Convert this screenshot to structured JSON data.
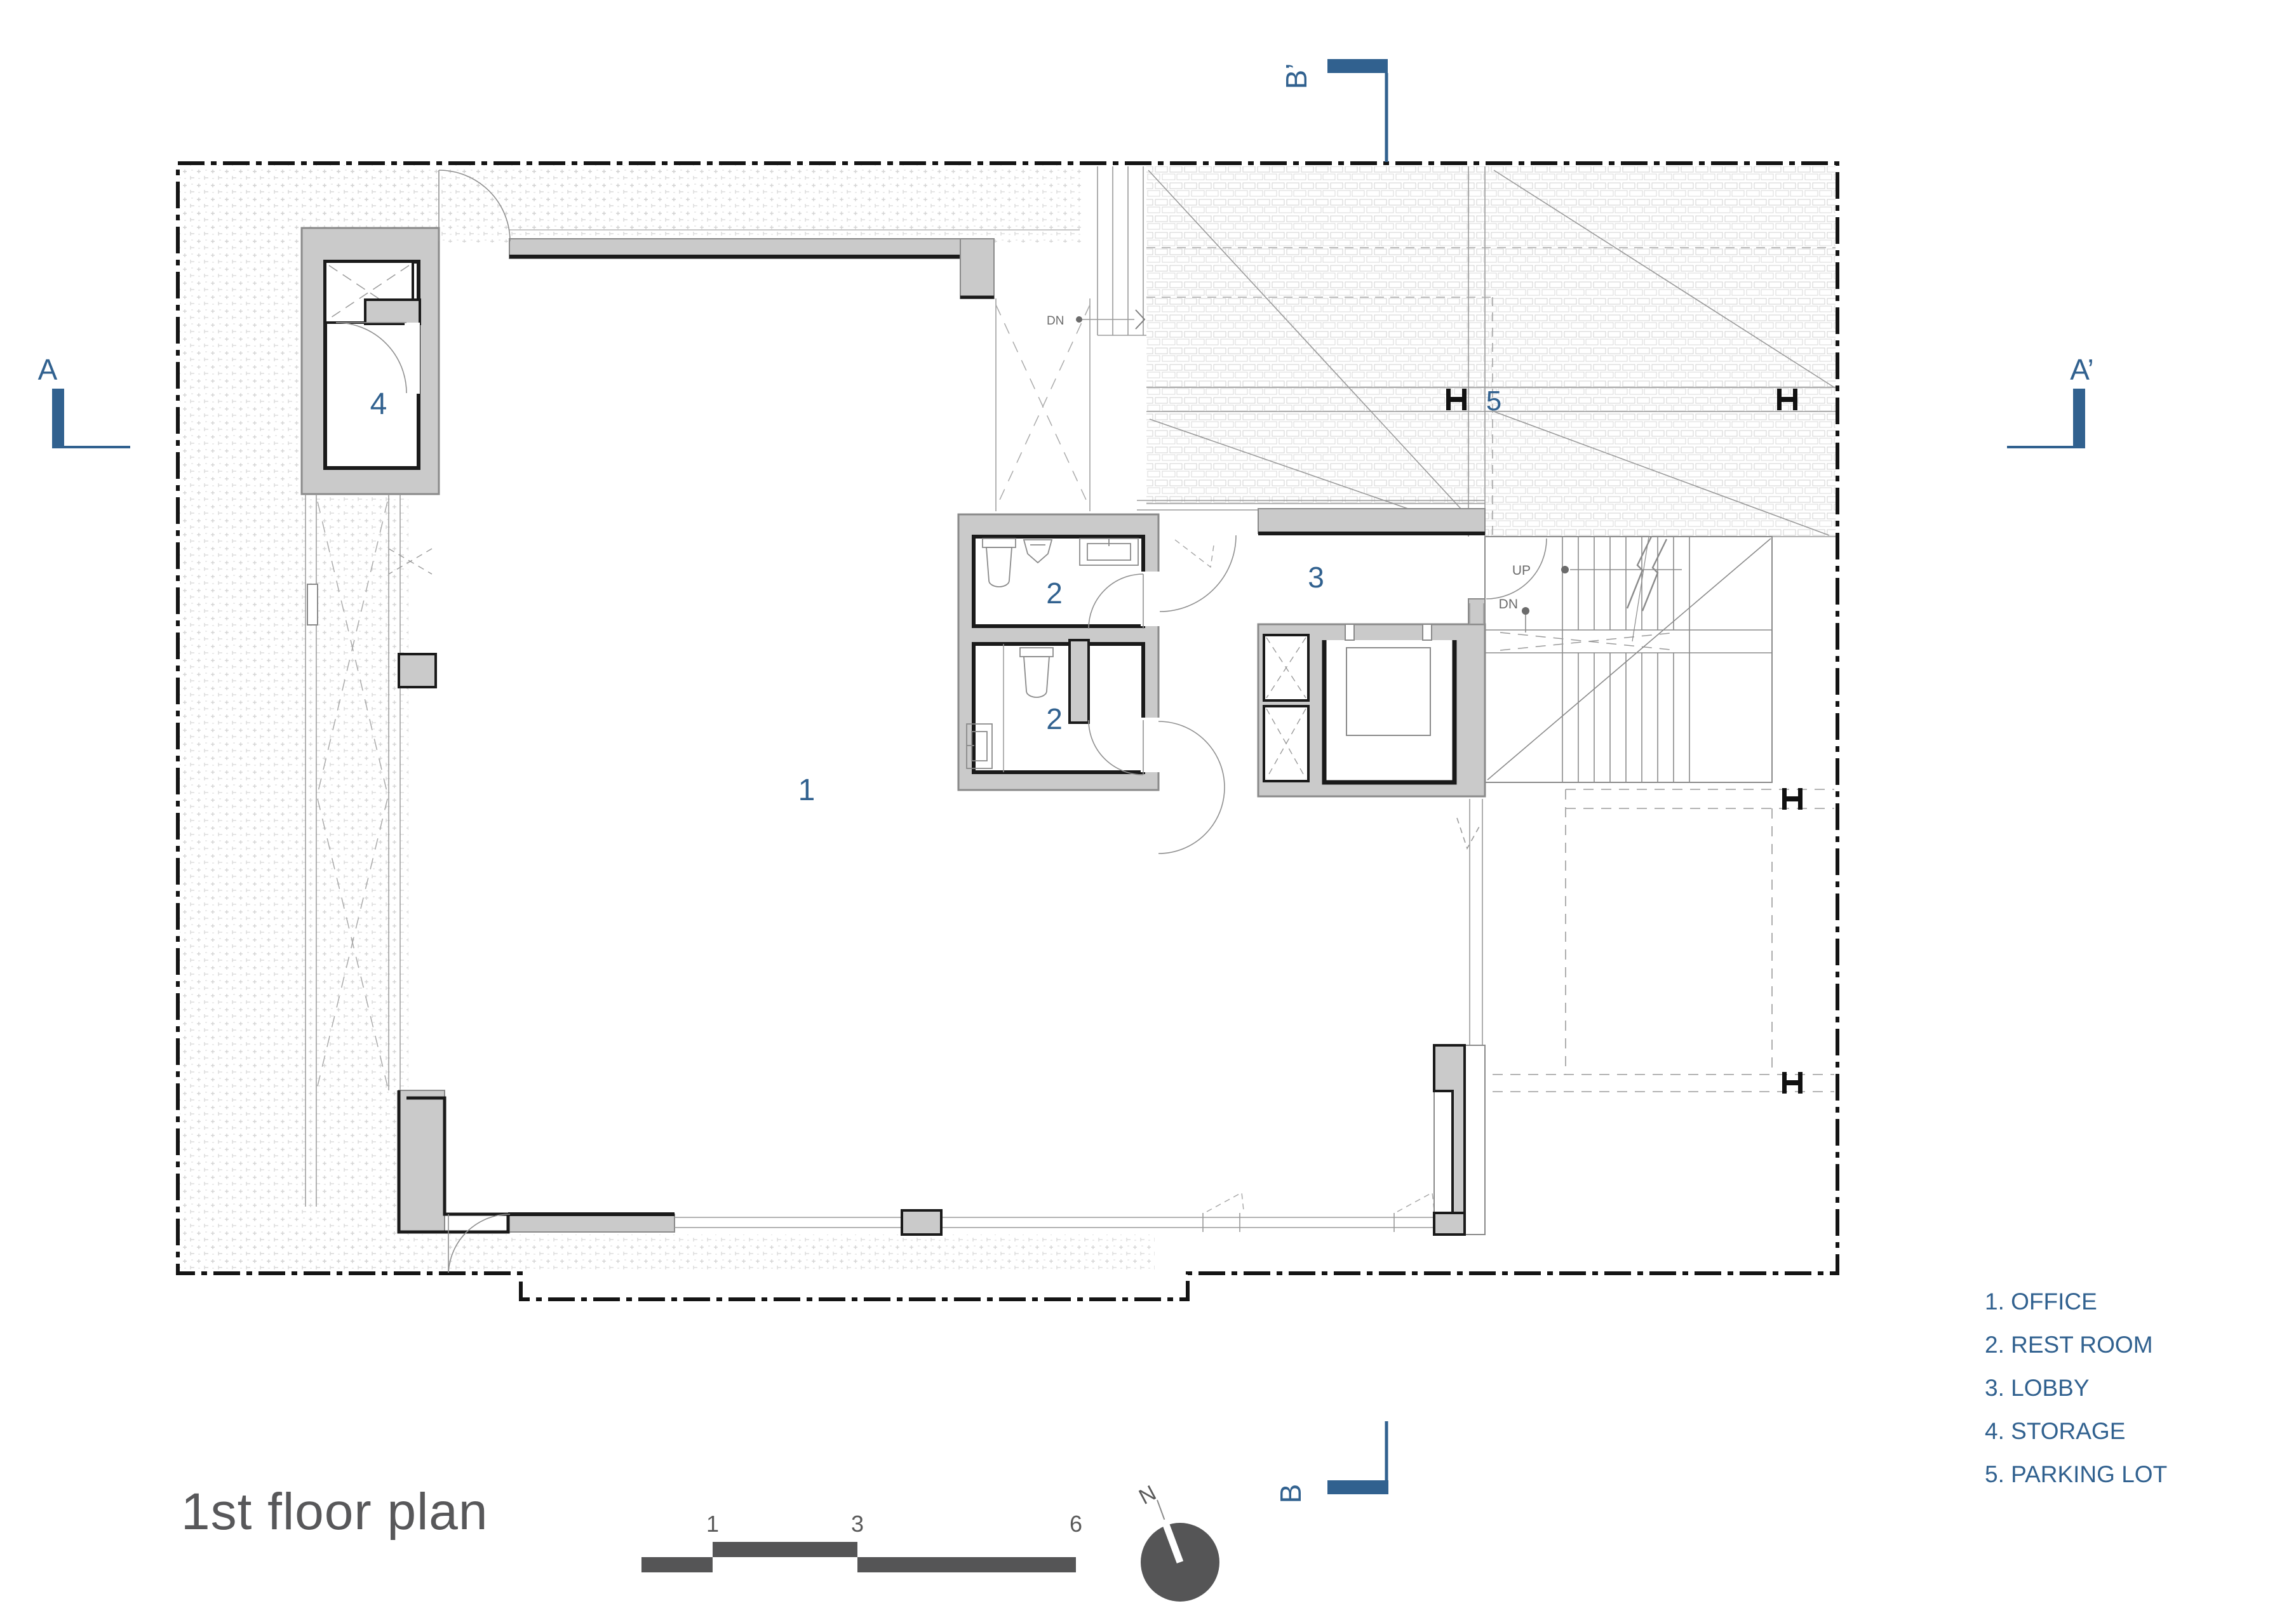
{
  "title": "1st floor plan",
  "legend": {
    "items": [
      "1. OFFICE",
      "2. REST ROOM",
      "3. LOBBY",
      "4. STORAGE",
      "5. PARKING LOT"
    ]
  },
  "rooms": {
    "office": "1",
    "restroom_upper": "2",
    "restroom_lower": "2",
    "lobby": "3",
    "storage": "4",
    "parking": "5"
  },
  "sections": {
    "a": "A",
    "a_prime": "A’",
    "b": "B",
    "b_prime": "B’"
  },
  "stairs": {
    "up": "UP",
    "dn": "DN"
  },
  "ramp": {
    "dn": "DN"
  },
  "scalebar": {
    "ticks": [
      "1",
      "3",
      "6"
    ]
  },
  "compass": {
    "north": "N"
  },
  "colors": {
    "accent": "#31618f",
    "wall_fill": "#cacaca",
    "line_dark": "#1a1a1a",
    "mid_gray": "#8a8a8a",
    "text_gray": "#58585a"
  }
}
